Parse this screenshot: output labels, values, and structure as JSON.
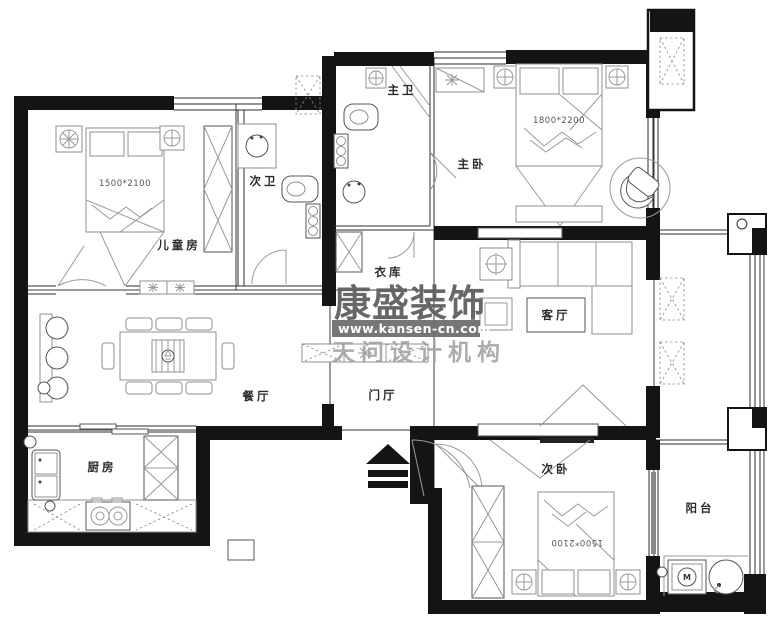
{
  "rooms": {
    "children": {
      "label": "儿童房",
      "bed_size": "1500*2100"
    },
    "second_bath": {
      "label": "次卫"
    },
    "master_bath": {
      "label": "主卫"
    },
    "master_bedroom": {
      "label": "主卧",
      "bed_size": "1800*2200"
    },
    "closet": {
      "label": "衣库"
    },
    "living": {
      "label": "客厅"
    },
    "dining": {
      "label": "餐厅"
    },
    "hall": {
      "label": "门厅"
    },
    "kitchen": {
      "label": "厨房"
    },
    "second_bedroom": {
      "label": "次卧",
      "bed_size": "1500*2100"
    },
    "balcony": {
      "label": "阳台"
    }
  },
  "watermark": {
    "brand": "康盛装饰",
    "website": "www.kansen-cn.com",
    "org": "天问设计机构"
  },
  "fixtures": {
    "washer_label": "M"
  },
  "colors": {
    "wall": "#141414",
    "line": "#2e2e2e",
    "furniture_line": "#8f8f8f",
    "watermark_text": "#5f5f5f",
    "watermark_band": "#6a6a6a",
    "watermark_org": "#a4a4a4"
  }
}
